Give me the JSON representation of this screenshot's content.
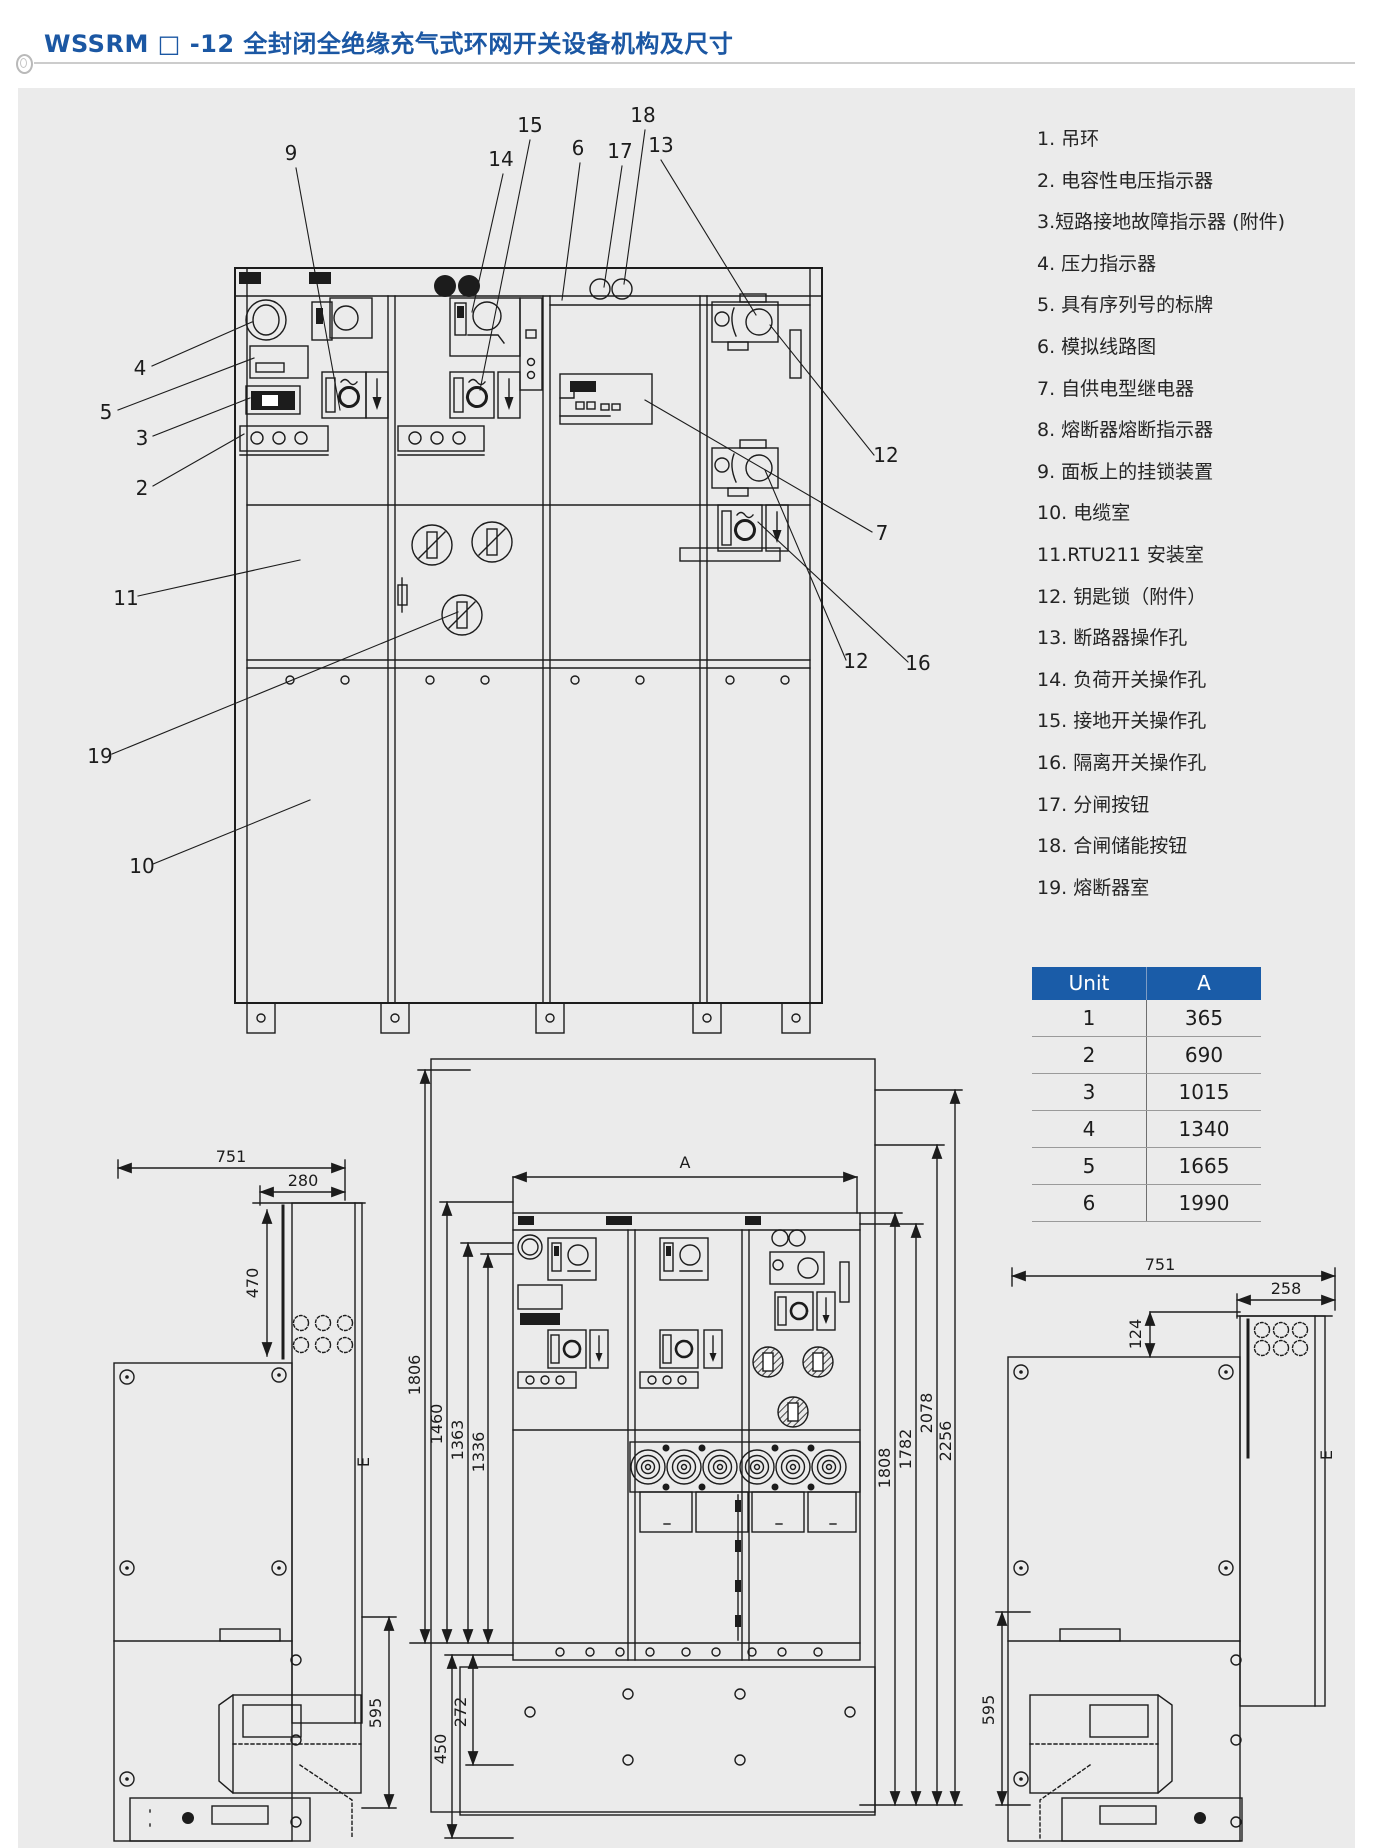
{
  "header": {
    "title": "WSSRM □ -12 全封闭全绝缘充气式环网开关设备机构及尺寸"
  },
  "legend": {
    "items": [
      "1. 吊环",
      "2. 电容性电压指示器",
      "3.短路接地故障指示器 (附件)",
      "4. 压力指示器",
      "5. 具有序列号的标牌",
      "6. 模拟线路图",
      "7. 自供电型继电器",
      "8. 熔断器熔断指示器",
      "9. 面板上的挂锁装置",
      "10. 电缆室",
      "11.RTU211 安装室",
      "12. 钥匙锁（附件）",
      "13. 断路器操作孔",
      "14. 负荷开关操作孔",
      "15. 接地开关操作孔",
      "16. 隔离开关操作孔",
      "17. 分闸按钮",
      "18. 合闸储能按钮",
      "19. 熔断器室"
    ]
  },
  "unit_table": {
    "headers": [
      "Unit",
      "A"
    ],
    "rows": [
      [
        "1",
        "365"
      ],
      [
        "2",
        "690"
      ],
      [
        "3",
        "1015"
      ],
      [
        "4",
        "1340"
      ],
      [
        "5",
        "1665"
      ],
      [
        "6",
        "1990"
      ]
    ]
  },
  "callouts": {
    "c9": "9",
    "c15": "15",
    "c14": "14",
    "c6": "6",
    "c17": "17",
    "c18": "18",
    "c13": "13",
    "c4": "4",
    "c5": "5",
    "c3": "3",
    "c2": "2",
    "c11": "11",
    "c19": "19",
    "c10": "10",
    "c12a": "12",
    "c7": "7",
    "c12b": "12",
    "c16": "16"
  },
  "left_view": {
    "d751": "751",
    "d280": "280",
    "d470": "470",
    "d595": "595",
    "e": "E"
  },
  "front_view": {
    "dA": "A",
    "d1806": "1806",
    "d1460": "1460",
    "d1363": "1363",
    "d1336": "1336",
    "d1808": "1808",
    "d1782": "1782",
    "d2078": "2078",
    "d2256": "2256",
    "d450": "450",
    "d272": "272"
  },
  "right_view": {
    "d751": "751",
    "d258": "258",
    "d124": "124",
    "d595": "595",
    "e": "E"
  },
  "colors": {
    "accent_blue": "#1a5ca8",
    "title_blue": "#1b57a3",
    "bg_gray": "#ebebeb",
    "line_dark": "#1c1c1c"
  }
}
